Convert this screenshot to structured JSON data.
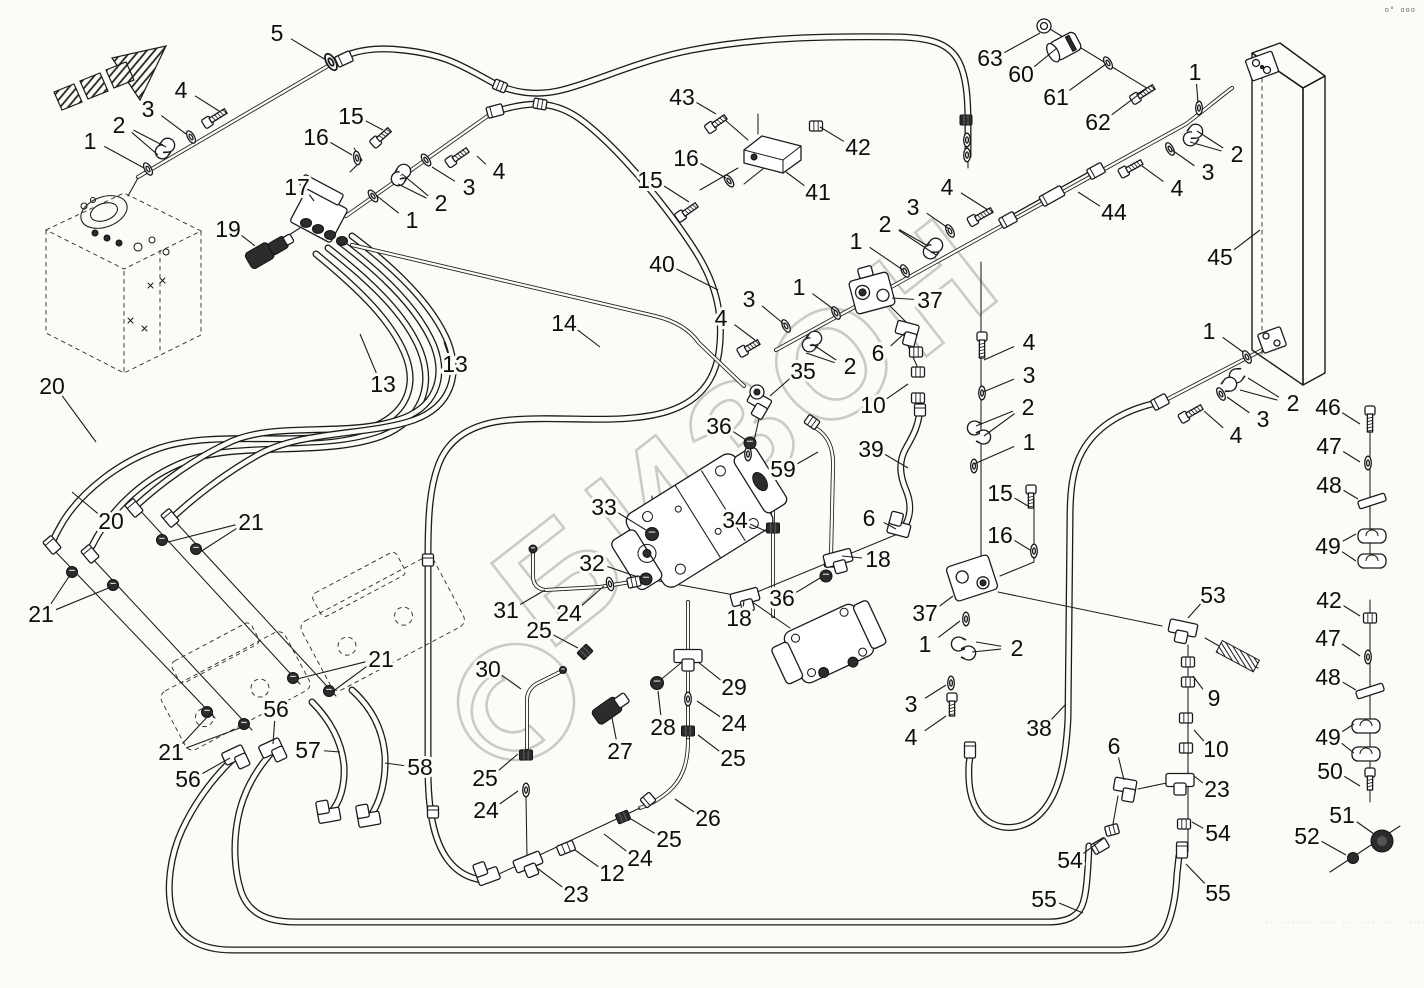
{
  "watermark": {
    "text": "БИЗОН",
    "logo_icon": "bizon-circle-logo",
    "color": "#c9ccc6"
  },
  "page_marks": {
    "top_right": "o° ooo",
    "bottom_right": "··· ········· ···· ··· ···· ··· ·· ···· ··· ···· ···· ····"
  },
  "labels": [
    {
      "t": "5",
      "x": 277,
      "y": 33,
      "l": [
        [
          326,
          60
        ]
      ]
    },
    {
      "t": "4",
      "x": 181,
      "y": 90,
      "l": [
        [
          219,
          111
        ]
      ]
    },
    {
      "t": "3",
      "x": 148,
      "y": 109,
      "l": [
        [
          186,
          134
        ]
      ]
    },
    {
      "t": "2",
      "x": 119,
      "y": 125,
      "l": [
        [
          158,
          155
        ],
        [
          166,
          147
        ]
      ]
    },
    {
      "t": "1",
      "x": 90,
      "y": 141,
      "l": [
        [
          144,
          168
        ]
      ]
    },
    {
      "t": "15",
      "x": 351,
      "y": 116,
      "l": [
        [
          383,
          130
        ]
      ]
    },
    {
      "t": "16",
      "x": 316,
      "y": 137,
      "l": [
        [
          352,
          155
        ]
      ]
    },
    {
      "t": "17",
      "x": 297,
      "y": 187,
      "l": [
        [
          314,
          201
        ]
      ]
    },
    {
      "t": "19",
      "x": 228,
      "y": 229,
      "l": [
        [
          255,
          246
        ]
      ]
    },
    {
      "t": "43",
      "x": 682,
      "y": 97,
      "l": [
        [
          716,
          114
        ]
      ]
    },
    {
      "t": "16",
      "x": 686,
      "y": 158,
      "l": [
        [
          726,
          178
        ]
      ]
    },
    {
      "t": "15",
      "x": 650,
      "y": 180,
      "l": [
        [
          689,
          202
        ]
      ]
    },
    {
      "t": "41",
      "x": 818,
      "y": 192,
      "l": [
        [
          786,
          172
        ]
      ]
    },
    {
      "t": "42",
      "x": 858,
      "y": 147,
      "l": [
        [
          820,
          127
        ]
      ]
    },
    {
      "t": "40",
      "x": 662,
      "y": 264,
      "l": [
        [
          718,
          290
        ]
      ]
    },
    {
      "t": "4",
      "x": 499,
      "y": 171,
      "l": [
        [
          477,
          156
        ]
      ]
    },
    {
      "t": "3",
      "x": 469,
      "y": 187,
      "l": [
        [
          432,
          167
        ]
      ]
    },
    {
      "t": "2",
      "x": 441,
      "y": 203,
      "l": [
        [
          402,
          174
        ],
        [
          398,
          184
        ]
      ]
    },
    {
      "t": "1",
      "x": 412,
      "y": 220,
      "l": [
        [
          377,
          196
        ]
      ]
    },
    {
      "t": "63",
      "x": 990,
      "y": 58,
      "l": [
        [
          1040,
          33
        ]
      ]
    },
    {
      "t": "60",
      "x": 1021,
      "y": 74,
      "l": [
        [
          1057,
          48
        ]
      ]
    },
    {
      "t": "61",
      "x": 1056,
      "y": 97,
      "l": [
        [
          1106,
          64
        ]
      ]
    },
    {
      "t": "62",
      "x": 1098,
      "y": 122,
      "l": [
        [
          1146,
          89
        ]
      ]
    },
    {
      "t": "1",
      "x": 1195,
      "y": 72,
      "l": [
        [
          1198,
          103
        ]
      ]
    },
    {
      "t": "2",
      "x": 1237,
      "y": 154,
      "l": [
        [
          1197,
          131
        ],
        [
          1190,
          142
        ]
      ]
    },
    {
      "t": "3",
      "x": 1208,
      "y": 172,
      "l": [
        [
          1172,
          150
        ]
      ]
    },
    {
      "t": "4",
      "x": 1177,
      "y": 188,
      "l": [
        [
          1142,
          166
        ]
      ]
    },
    {
      "t": "44",
      "x": 1114,
      "y": 212,
      "l": [
        [
          1078,
          192
        ]
      ]
    },
    {
      "t": "45",
      "x": 1220,
      "y": 257,
      "l": [
        [
          1260,
          230
        ]
      ]
    },
    {
      "t": "4",
      "x": 947,
      "y": 187,
      "l": [
        [
          988,
          210
        ]
      ]
    },
    {
      "t": "3",
      "x": 913,
      "y": 207,
      "l": [
        [
          948,
          228
        ]
      ]
    },
    {
      "t": "2",
      "x": 885,
      "y": 224,
      "l": [
        [
          928,
          246
        ],
        [
          936,
          255
        ]
      ]
    },
    {
      "t": "1",
      "x": 856,
      "y": 241,
      "l": [
        [
          903,
          270
        ]
      ]
    },
    {
      "t": "1",
      "x": 799,
      "y": 287,
      "l": [
        [
          836,
          311
        ]
      ]
    },
    {
      "t": "37",
      "x": 930,
      "y": 300,
      "l": [
        [
          892,
          298
        ]
      ]
    },
    {
      "t": "3",
      "x": 749,
      "y": 299,
      "l": [
        [
          784,
          324
        ]
      ]
    },
    {
      "t": "4",
      "x": 721,
      "y": 318,
      "l": [
        [
          755,
          340
        ]
      ]
    },
    {
      "t": "2",
      "x": 850,
      "y": 366,
      "l": [
        [
          812,
          344
        ],
        [
          806,
          353
        ]
      ]
    },
    {
      "t": "6",
      "x": 878,
      "y": 353,
      "l": [
        [
          906,
          332
        ]
      ]
    },
    {
      "t": "35",
      "x": 803,
      "y": 371,
      "l": [
        [
          770,
          396
        ]
      ]
    },
    {
      "t": "10",
      "x": 873,
      "y": 405,
      "l": [
        [
          908,
          384
        ]
      ]
    },
    {
      "t": "36",
      "x": 719,
      "y": 426,
      "l": [
        [
          746,
          440
        ]
      ]
    },
    {
      "t": "59",
      "x": 783,
      "y": 469,
      "l": [
        [
          818,
          452
        ]
      ]
    },
    {
      "t": "39",
      "x": 871,
      "y": 449,
      "l": [
        [
          908,
          468
        ]
      ]
    },
    {
      "t": "14",
      "x": 564,
      "y": 323,
      "l": [
        [
          600,
          347
        ]
      ]
    },
    {
      "t": "13",
      "x": 455,
      "y": 364,
      "l": [
        [
          444,
          342
        ]
      ]
    },
    {
      "t": "13",
      "x": 383,
      "y": 384,
      "l": [
        [
          360,
          334
        ]
      ]
    },
    {
      "t": "20",
      "x": 52,
      "y": 386,
      "l": [
        [
          96,
          442
        ]
      ]
    },
    {
      "t": "20",
      "x": 111,
      "y": 521,
      "l": [
        [
          72,
          492
        ]
      ]
    },
    {
      "t": "21",
      "x": 251,
      "y": 522,
      "l": [
        [
          168,
          542
        ],
        [
          200,
          552
        ]
      ]
    },
    {
      "t": "21",
      "x": 41,
      "y": 614,
      "l": [
        [
          70,
          575
        ],
        [
          111,
          587
        ]
      ]
    },
    {
      "t": "21",
      "x": 381,
      "y": 659,
      "l": [
        [
          297,
          679
        ],
        [
          332,
          692
        ]
      ]
    },
    {
      "t": "21",
      "x": 171,
      "y": 752,
      "l": [
        [
          210,
          714
        ],
        [
          245,
          726
        ]
      ]
    },
    {
      "t": "56",
      "x": 276,
      "y": 709,
      "l": [
        [
          273,
          744
        ]
      ]
    },
    {
      "t": "56",
      "x": 188,
      "y": 779,
      "l": [
        [
          230,
          758
        ]
      ]
    },
    {
      "t": "57",
      "x": 308,
      "y": 750,
      "l": [
        [
          340,
          752
        ]
      ]
    },
    {
      "t": "58",
      "x": 420,
      "y": 767,
      "l": [
        [
          385,
          763
        ]
      ]
    },
    {
      "t": "33",
      "x": 604,
      "y": 507,
      "l": [
        [
          646,
          530
        ]
      ]
    },
    {
      "t": "34",
      "x": 735,
      "y": 520,
      "l": [
        [
          768,
          532
        ]
      ]
    },
    {
      "t": "32",
      "x": 592,
      "y": 563,
      "l": [
        [
          638,
          577
        ]
      ]
    },
    {
      "t": "31",
      "x": 506,
      "y": 610,
      "l": [
        [
          545,
          590
        ]
      ]
    },
    {
      "t": "24",
      "x": 569,
      "y": 613,
      "l": [
        [
          604,
          586
        ]
      ]
    },
    {
      "t": "25",
      "x": 539,
      "y": 630,
      "l": [
        [
          578,
          648
        ]
      ]
    },
    {
      "t": "36",
      "x": 782,
      "y": 598,
      "l": [
        [
          820,
          578
        ]
      ]
    },
    {
      "t": "18",
      "x": 739,
      "y": 618,
      "l": [
        [
          744,
          600
        ]
      ]
    },
    {
      "t": "6",
      "x": 869,
      "y": 518,
      "l": [
        [
          896,
          529
        ]
      ]
    },
    {
      "t": "18",
      "x": 878,
      "y": 559,
      "l": [
        [
          842,
          556
        ]
      ]
    },
    {
      "t": "4",
      "x": 1029,
      "y": 342,
      "l": [
        [
          984,
          360
        ]
      ]
    },
    {
      "t": "3",
      "x": 1029,
      "y": 375,
      "l": [
        [
          983,
          392
        ]
      ]
    },
    {
      "t": "2",
      "x": 1028,
      "y": 407,
      "l": [
        [
          976,
          426
        ],
        [
          984,
          436
        ]
      ]
    },
    {
      "t": "1",
      "x": 1029,
      "y": 442,
      "l": [
        [
          974,
          464
        ]
      ]
    },
    {
      "t": "15",
      "x": 1000,
      "y": 493,
      "l": [
        [
          1028,
          506
        ]
      ]
    },
    {
      "t": "16",
      "x": 1000,
      "y": 535,
      "l": [
        [
          1030,
          550
        ]
      ]
    },
    {
      "t": "37",
      "x": 925,
      "y": 613,
      "l": [
        [
          953,
          596
        ]
      ]
    },
    {
      "t": "1",
      "x": 925,
      "y": 644,
      "l": [
        [
          960,
          621
        ]
      ]
    },
    {
      "t": "2",
      "x": 1017,
      "y": 648,
      "l": [
        [
          976,
          642
        ],
        [
          972,
          652
        ]
      ]
    },
    {
      "t": "3",
      "x": 911,
      "y": 704,
      "l": [
        [
          946,
          685
        ]
      ]
    },
    {
      "t": "4",
      "x": 911,
      "y": 737,
      "l": [
        [
          946,
          716
        ]
      ]
    },
    {
      "t": "38",
      "x": 1039,
      "y": 728,
      "l": [
        [
          1066,
          704
        ]
      ]
    },
    {
      "t": "6",
      "x": 1114,
      "y": 746,
      "l": [
        [
          1124,
          780
        ]
      ]
    },
    {
      "t": "53",
      "x": 1213,
      "y": 595,
      "l": [
        [
          1188,
          618
        ]
      ]
    },
    {
      "t": "1",
      "x": 1209,
      "y": 331,
      "l": [
        [
          1243,
          352
        ]
      ]
    },
    {
      "t": "2",
      "x": 1293,
      "y": 403,
      "l": [
        [
          1248,
          378
        ],
        [
          1240,
          390
        ]
      ]
    },
    {
      "t": "3",
      "x": 1263,
      "y": 419,
      "l": [
        [
          1227,
          397
        ]
      ]
    },
    {
      "t": "4",
      "x": 1236,
      "y": 435,
      "l": [
        [
          1204,
          411
        ]
      ]
    },
    {
      "t": "46",
      "x": 1328,
      "y": 407,
      "l": [
        [
          1360,
          424
        ]
      ]
    },
    {
      "t": "47",
      "x": 1329,
      "y": 446,
      "l": [
        [
          1360,
          462
        ]
      ]
    },
    {
      "t": "48",
      "x": 1329,
      "y": 485,
      "l": [
        [
          1358,
          499
        ]
      ]
    },
    {
      "t": "49",
      "x": 1328,
      "y": 546,
      "l": [
        [
          1356,
          534
        ],
        [
          1356,
          561
        ]
      ]
    },
    {
      "t": "42",
      "x": 1329,
      "y": 600,
      "l": [
        [
          1360,
          616
        ]
      ]
    },
    {
      "t": "47",
      "x": 1328,
      "y": 638,
      "l": [
        [
          1360,
          656
        ]
      ]
    },
    {
      "t": "48",
      "x": 1328,
      "y": 677,
      "l": [
        [
          1356,
          690
        ]
      ]
    },
    {
      "t": "49",
      "x": 1328,
      "y": 737,
      "l": [
        [
          1354,
          724
        ],
        [
          1354,
          753
        ]
      ]
    },
    {
      "t": "50",
      "x": 1330,
      "y": 771,
      "l": [
        [
          1360,
          786
        ]
      ]
    },
    {
      "t": "51",
      "x": 1342,
      "y": 815,
      "l": [
        [
          1374,
          834
        ]
      ]
    },
    {
      "t": "52",
      "x": 1307,
      "y": 836,
      "l": [
        [
          1346,
          855
        ]
      ]
    },
    {
      "t": "9",
      "x": 1214,
      "y": 698,
      "l": [
        [
          1193,
          676
        ]
      ]
    },
    {
      "t": "10",
      "x": 1216,
      "y": 749,
      "l": [
        [
          1194,
          730
        ]
      ]
    },
    {
      "t": "23",
      "x": 1217,
      "y": 789,
      "l": [
        [
          1194,
          776
        ]
      ]
    },
    {
      "t": "54",
      "x": 1218,
      "y": 833,
      "l": [
        [
          1192,
          822
        ]
      ]
    },
    {
      "t": "55",
      "x": 1218,
      "y": 893,
      "l": [
        [
          1186,
          864
        ]
      ]
    },
    {
      "t": "29",
      "x": 734,
      "y": 687,
      "l": [
        [
          698,
          662
        ]
      ]
    },
    {
      "t": "24",
      "x": 734,
      "y": 723,
      "l": [
        [
          697,
          701
        ]
      ]
    },
    {
      "t": "28",
      "x": 663,
      "y": 727,
      "l": [
        [
          658,
          691
        ]
      ]
    },
    {
      "t": "27",
      "x": 620,
      "y": 751,
      "l": [
        [
          612,
          718
        ]
      ]
    },
    {
      "t": "25",
      "x": 733,
      "y": 758,
      "l": [
        [
          698,
          735
        ]
      ]
    },
    {
      "t": "26",
      "x": 708,
      "y": 818,
      "l": [
        [
          675,
          799
        ]
      ]
    },
    {
      "t": "25",
      "x": 669,
      "y": 839,
      "l": [
        [
          631,
          819
        ]
      ]
    },
    {
      "t": "24",
      "x": 640,
      "y": 858,
      "l": [
        [
          604,
          834
        ]
      ]
    },
    {
      "t": "12",
      "x": 612,
      "y": 873,
      "l": [
        [
          575,
          850
        ]
      ]
    },
    {
      "t": "23",
      "x": 576,
      "y": 894,
      "l": [
        [
          537,
          868
        ]
      ]
    },
    {
      "t": "30",
      "x": 488,
      "y": 669,
      "l": [
        [
          521,
          689
        ]
      ]
    },
    {
      "t": "25",
      "x": 485,
      "y": 778,
      "l": [
        [
          518,
          754
        ]
      ]
    },
    {
      "t": "24",
      "x": 486,
      "y": 810,
      "l": [
        [
          518,
          791
        ]
      ]
    },
    {
      "t": "54",
      "x": 1070,
      "y": 860,
      "l": [
        [
          1104,
          838
        ]
      ]
    },
    {
      "t": "55",
      "x": 1044,
      "y": 899,
      "l": [
        [
          1083,
          913
        ]
      ]
    }
  ]
}
